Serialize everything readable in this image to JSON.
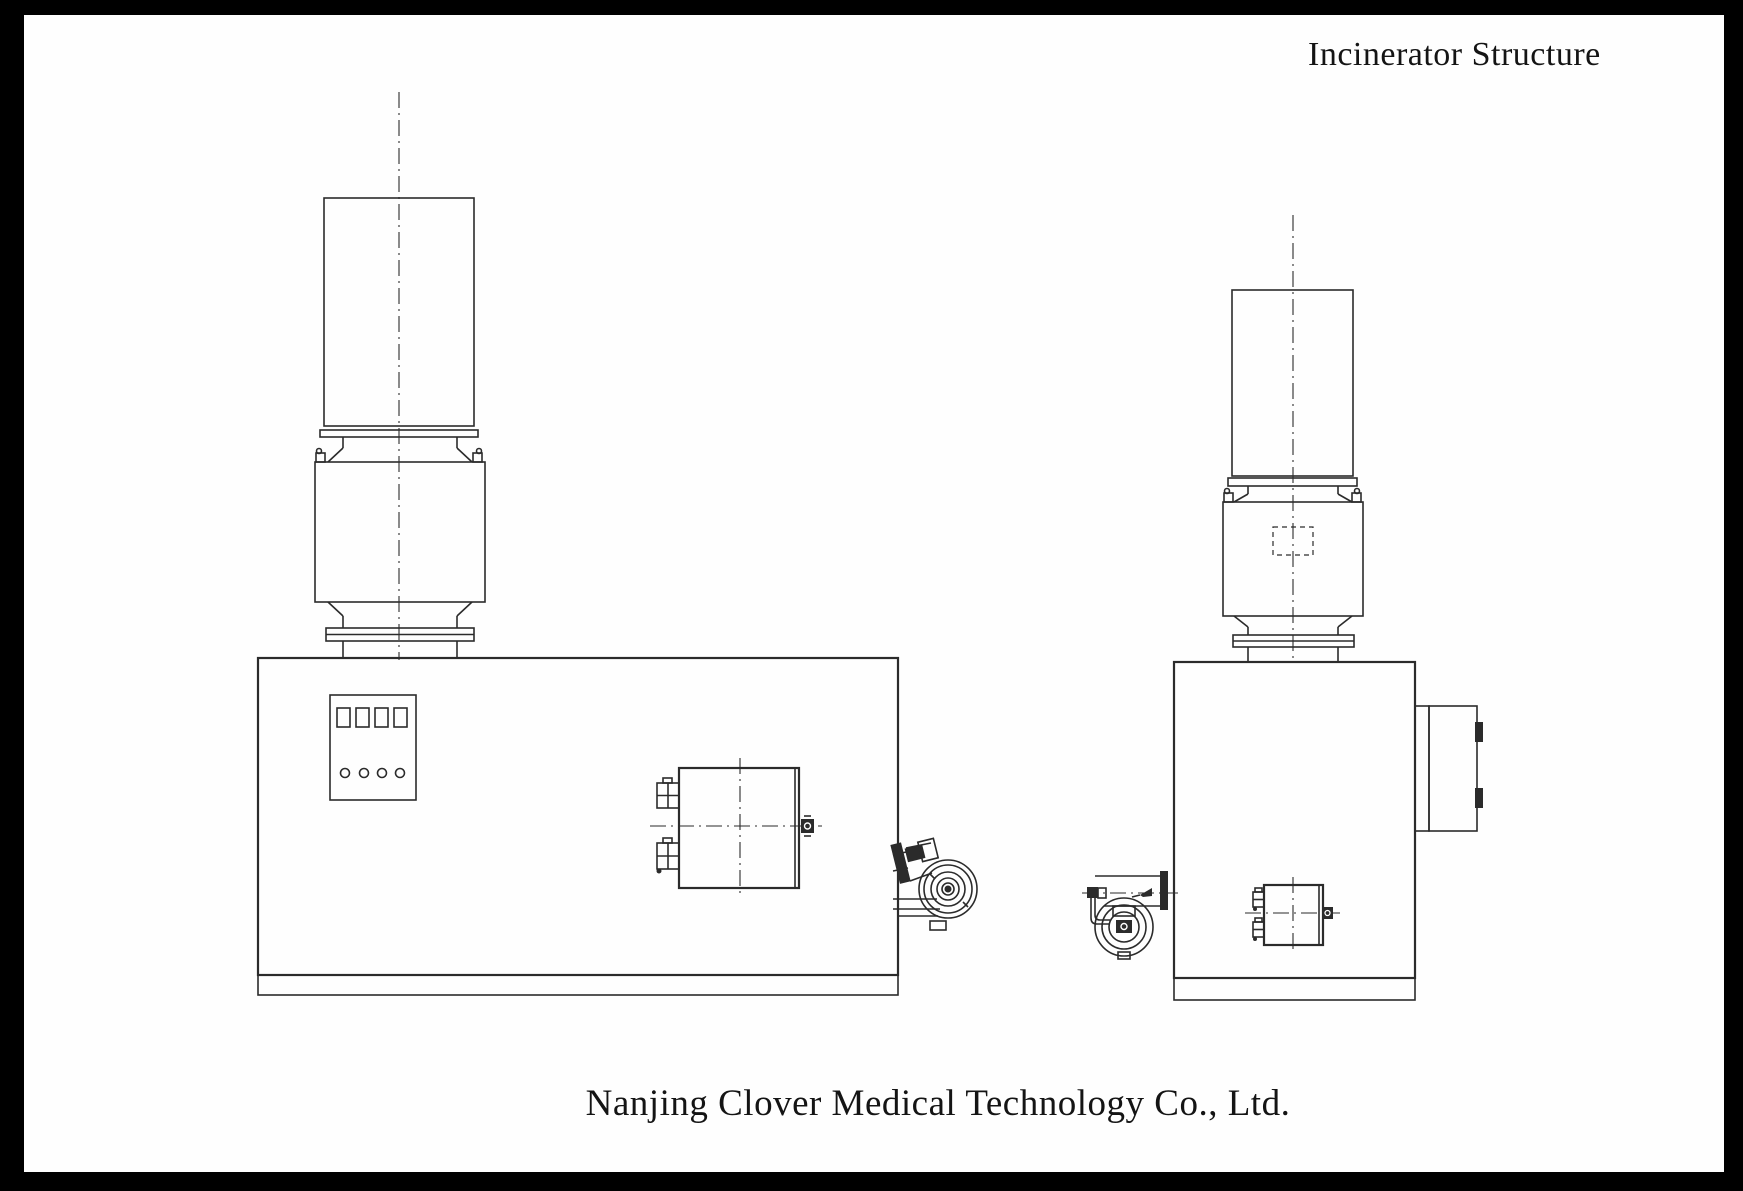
{
  "title": {
    "text": "Incinerator Structure"
  },
  "footer": {
    "text": "Nanjing Clover Medical Technology Co., Ltd."
  },
  "colors": {
    "frame": "#000000",
    "paper": "#fefefe",
    "ink": "#2b2b2b"
  },
  "drawing": {
    "views": [
      {
        "id": "side-view",
        "components": [
          "chimney-stack",
          "flange-joint",
          "secondary-chamber",
          "lifting-lug",
          "main-chamber-body",
          "control-panel",
          "burner-box",
          "sight-fitting",
          "draft-fan",
          "base-skid"
        ]
      },
      {
        "id": "front-view",
        "components": [
          "chimney-stack",
          "flange-joint",
          "secondary-chamber",
          "inspection-port",
          "main-chamber-body",
          "loading-door",
          "door-hinge",
          "oil-burner",
          "burner-box",
          "base-skid"
        ]
      }
    ]
  }
}
